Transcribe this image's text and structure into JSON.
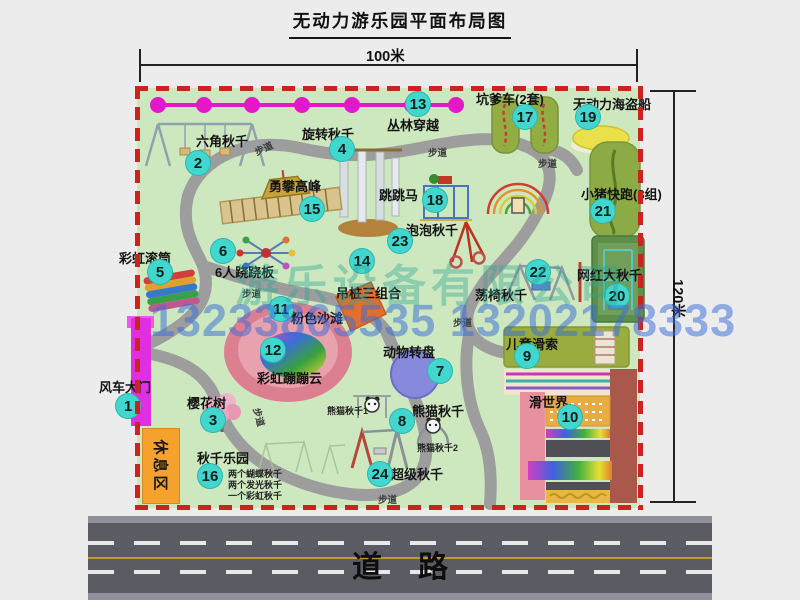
{
  "title": "无动力游乐园平面布局图",
  "dimensions": {
    "width": "100米",
    "height": "120米"
  },
  "road": {
    "label": "道路"
  },
  "watermark": {
    "company": "游乐设备有限公司",
    "phone": "13233865535 13202178333"
  },
  "rest_area": {
    "label": "休息区"
  },
  "colors": {
    "park_green": "#cde8bf",
    "border_red": "#c9241e",
    "badge_teal": "#41d7cf",
    "road_gray": "#5b5b64",
    "gate_magenta": "#e12ee1",
    "path_gray": "#9d9d9d",
    "zipline_pink": "#e318c9",
    "rest_orange": "#f5a12d"
  },
  "attractions": [
    {
      "num": "1",
      "label": "风车大门",
      "badge": [
        128,
        406
      ],
      "label_pos": [
        99,
        377
      ]
    },
    {
      "num": "2",
      "label": "六角秋千",
      "badge": [
        198,
        163
      ],
      "label_pos": [
        196,
        131
      ]
    },
    {
      "num": "3",
      "label": "樱花树",
      "badge": [
        213,
        420
      ],
      "label_pos": [
        187,
        393
      ]
    },
    {
      "num": "4",
      "label": "旋转秋千",
      "badge": [
        342,
        149
      ],
      "label_pos": [
        302,
        124
      ]
    },
    {
      "num": "5",
      "label": "彩虹滚筒",
      "badge": [
        160,
        272
      ],
      "label_pos": [
        119,
        248
      ]
    },
    {
      "num": "6",
      "label": "6人跷跷板",
      "badge": [
        223,
        251
      ],
      "label_pos": [
        215,
        262
      ]
    },
    {
      "num": "7",
      "label": "动物转盘",
      "badge": [
        440,
        371
      ],
      "label_pos": [
        383,
        342
      ]
    },
    {
      "num": "8",
      "label": "熊猫秋千",
      "badge": [
        402,
        421
      ],
      "label_pos": [
        412,
        401
      ]
    },
    {
      "num": "9",
      "label": "儿童滑索",
      "badge": [
        527,
        356
      ],
      "label_pos": [
        506,
        334
      ]
    },
    {
      "num": "10",
      "label": "滑世界",
      "badge": [
        570,
        417
      ],
      "label_pos": [
        529,
        392
      ]
    },
    {
      "num": "11",
      "label": "粉色沙滩",
      "badge": [
        281,
        309
      ],
      "label_pos": [
        291,
        308
      ]
    },
    {
      "num": "12",
      "label": "彩虹蹦蹦云",
      "badge": [
        273,
        350
      ],
      "label_pos": [
        257,
        368
      ]
    },
    {
      "num": "13",
      "label": "丛林穿越",
      "badge": [
        418,
        104
      ],
      "label_pos": [
        387,
        115
      ]
    },
    {
      "num": "14",
      "label": "吊桩三组合",
      "badge": [
        362,
        261
      ],
      "label_pos": [
        336,
        283
      ]
    },
    {
      "num": "15",
      "label": "勇攀高峰",
      "badge": [
        312,
        209
      ],
      "label_pos": [
        269,
        176
      ]
    },
    {
      "num": "16",
      "label": "秋千乐园",
      "badge": [
        210,
        476
      ],
      "label_pos": [
        197,
        448
      ]
    },
    {
      "num": "17",
      "label": "坑爹车(2套)",
      "badge": [
        525,
        117
      ],
      "label_pos": [
        476,
        89
      ]
    },
    {
      "num": "18",
      "label": "跳跳马",
      "badge": [
        435,
        200
      ],
      "label_pos": [
        379,
        185
      ]
    },
    {
      "num": "19",
      "label": "无动力海盗船",
      "badge": [
        588,
        117
      ],
      "label_pos": [
        573,
        94
      ]
    },
    {
      "num": "20",
      "label": "网红大秋千",
      "badge": [
        617,
        296
      ],
      "label_pos": [
        577,
        265
      ]
    },
    {
      "num": "21",
      "label": "小猪快跑(3组)",
      "badge": [
        603,
        211
      ],
      "label_pos": [
        581,
        184
      ]
    },
    {
      "num": "22",
      "label": "荡椅秋千",
      "badge": [
        538,
        272
      ],
      "label_pos": [
        475,
        285
      ]
    },
    {
      "num": "23",
      "label": "泡泡秋千",
      "badge": [
        400,
        241
      ],
      "label_pos": [
        406,
        220
      ]
    },
    {
      "num": "24",
      "label": "超级秋千",
      "badge": [
        380,
        474
      ],
      "label_pos": [
        391,
        464
      ]
    }
  ],
  "small_labels": [
    {
      "text": "熊猫秋千1",
      "pos": [
        327,
        404
      ]
    },
    {
      "text": "熊猫秋千2",
      "pos": [
        417,
        441
      ]
    },
    {
      "text": "两个蝴蝶秋千",
      "pos": [
        228,
        467
      ]
    },
    {
      "text": "两个发光秋千",
      "pos": [
        228,
        478
      ]
    },
    {
      "text": "一个彩虹秋千",
      "pos": [
        228,
        489
      ]
    }
  ],
  "path_labels": [
    {
      "text": "步道",
      "pos": [
        254,
        141
      ],
      "rot": -25
    },
    {
      "text": "步道",
      "pos": [
        428,
        145
      ],
      "rot": 0
    },
    {
      "text": "步道",
      "pos": [
        538,
        156
      ],
      "rot": 0
    },
    {
      "text": "步道",
      "pos": [
        242,
        286
      ],
      "rot": 0
    },
    {
      "text": "步道",
      "pos": [
        453,
        315
      ],
      "rot": 0
    },
    {
      "text": "步道",
      "pos": [
        250,
        410
      ],
      "rot": 75
    },
    {
      "text": "步道",
      "pos": [
        378,
        492
      ],
      "rot": 0
    }
  ]
}
